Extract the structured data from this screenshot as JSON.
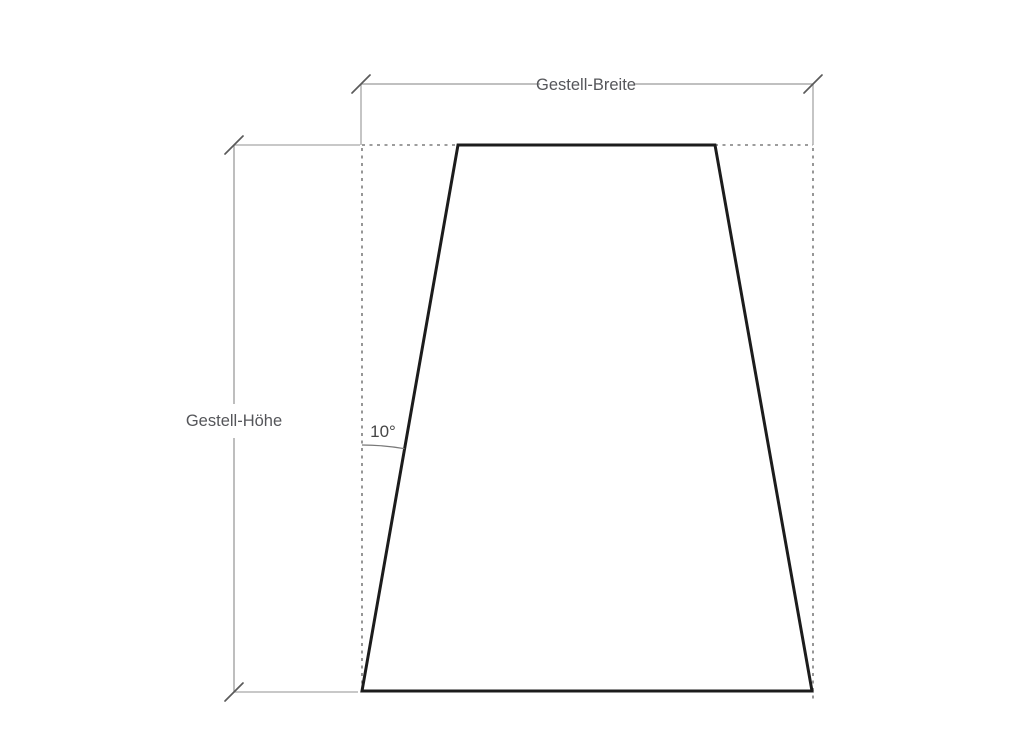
{
  "drawing": {
    "type": "technical-dimension-drawing",
    "shape": "trapezoid-frame-cross-section",
    "labels": {
      "width_dimension": "Gestell-Breite",
      "height_dimension": "Gestell-Höhe",
      "angle": "10°"
    },
    "angle_deg": 10
  },
  "colors": {
    "background": "#ffffff",
    "outline": "#1c1c1c",
    "dimension_line": "#9b9b9b",
    "extension_line": "#a6a6a6",
    "dashed_line": "#7d7d7d",
    "tick": "#5a5a5a",
    "arc": "#787878",
    "label_text": "#55565a",
    "angle_text": "#464646"
  }
}
